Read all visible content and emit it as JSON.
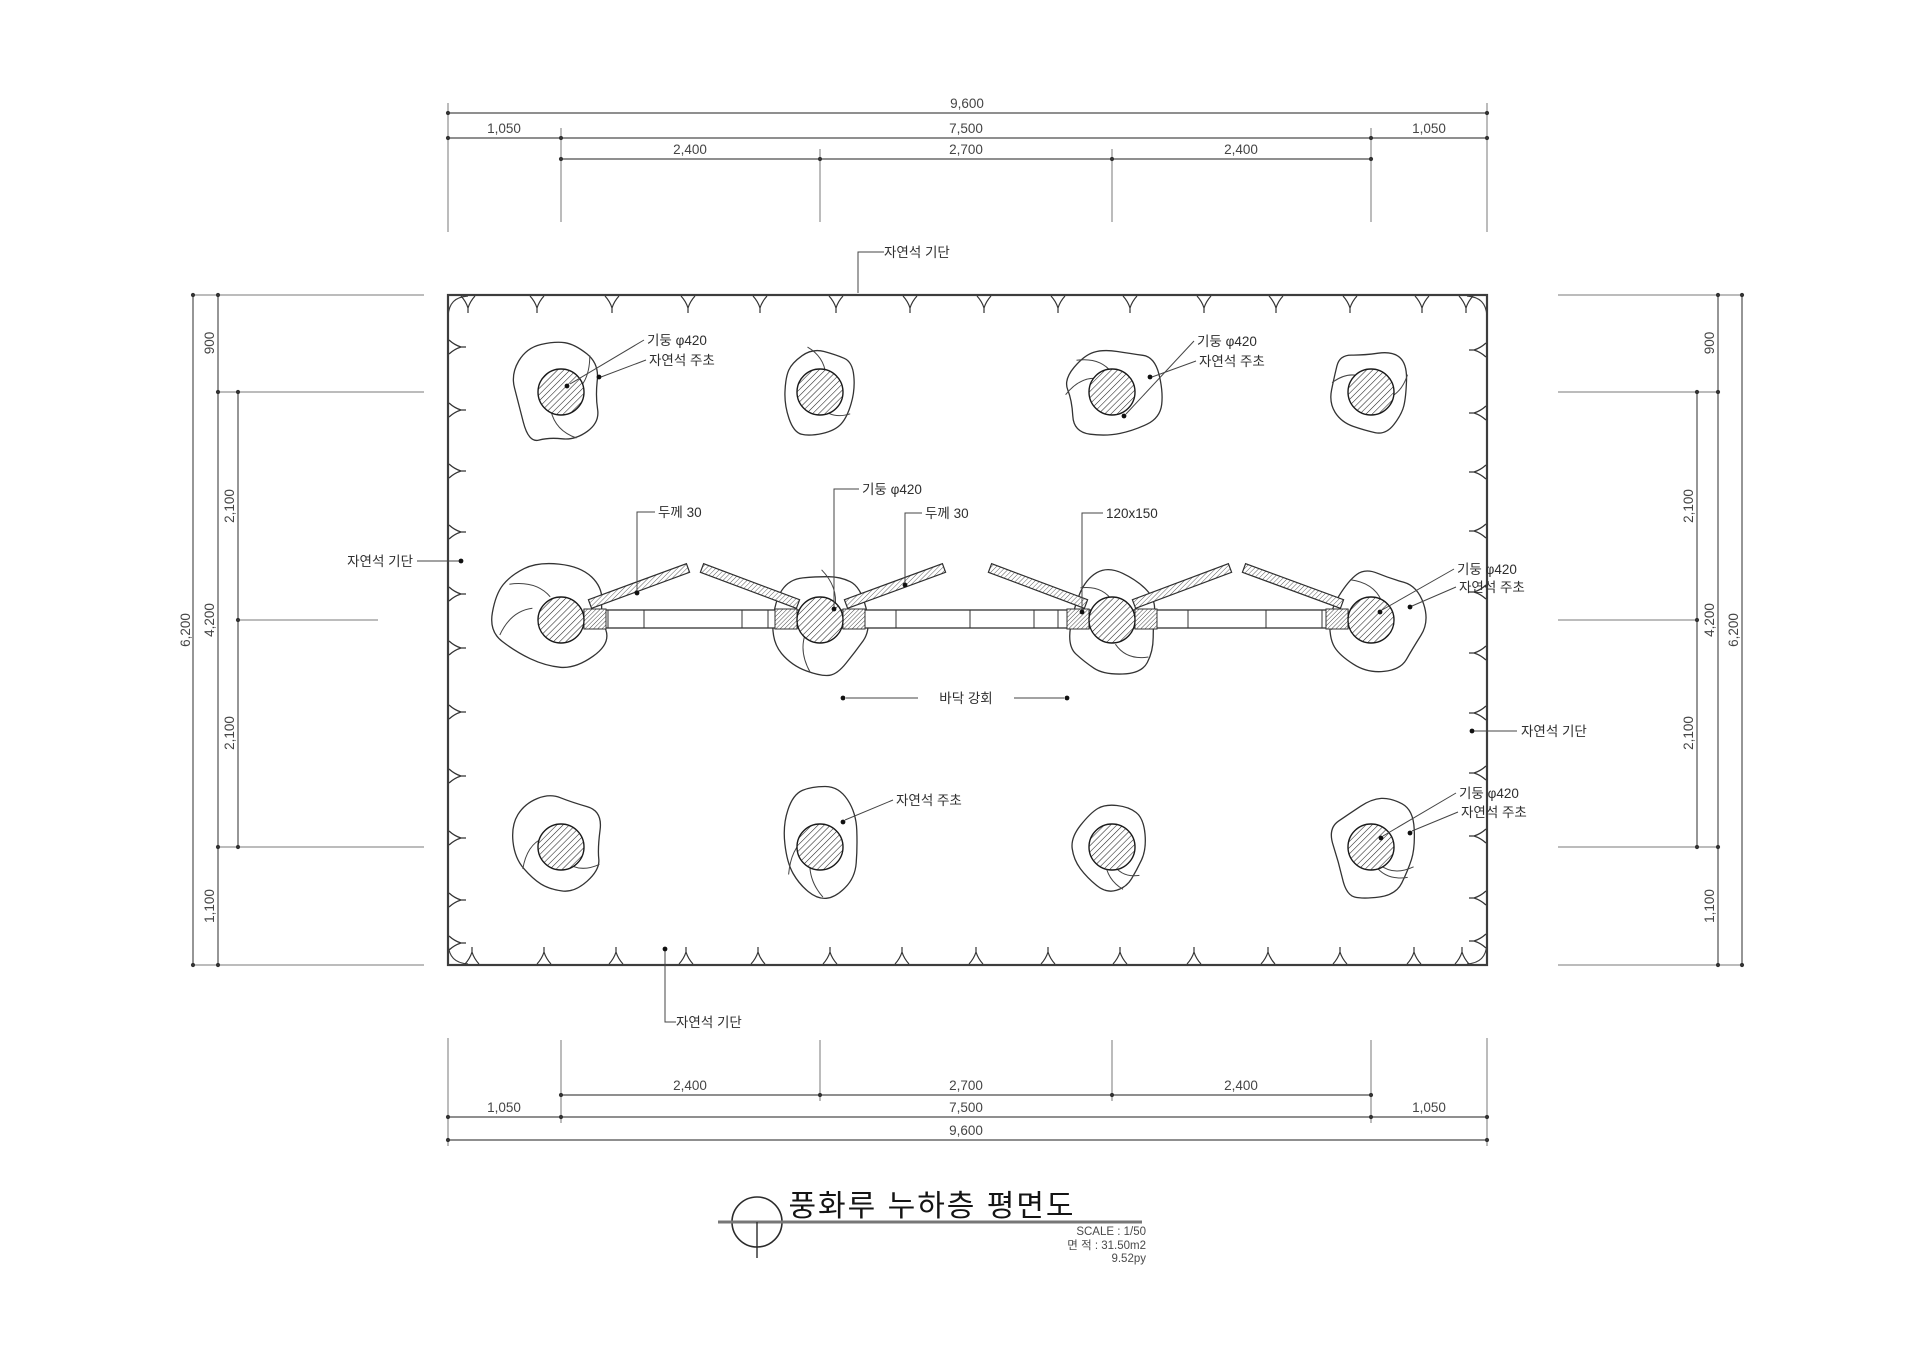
{
  "title_block": {
    "title": "풍화루 누하층 평면도",
    "scale": "SCALE : 1/50",
    "area": "면 적 : 31.50m2",
    "area_pyeong": "9.52py"
  },
  "dimensions": {
    "horizontal": {
      "total": "9,600",
      "mid": [
        "1,050",
        "7,500",
        "1,050"
      ],
      "inner": [
        "2,400",
        "2,700",
        "2,400"
      ]
    },
    "vertical": {
      "total": "6,200",
      "span": "4,200",
      "top": "900",
      "upper": "2,100",
      "lower": "2,100",
      "bottom": "1,100"
    }
  },
  "labels": {
    "stone_base": "자연석 기단",
    "column": "기둥 φ420",
    "stone_footing": "자연석 주초",
    "thickness": "두께 30",
    "member_size": "120x150",
    "floor_finish": "바닥 강회"
  }
}
